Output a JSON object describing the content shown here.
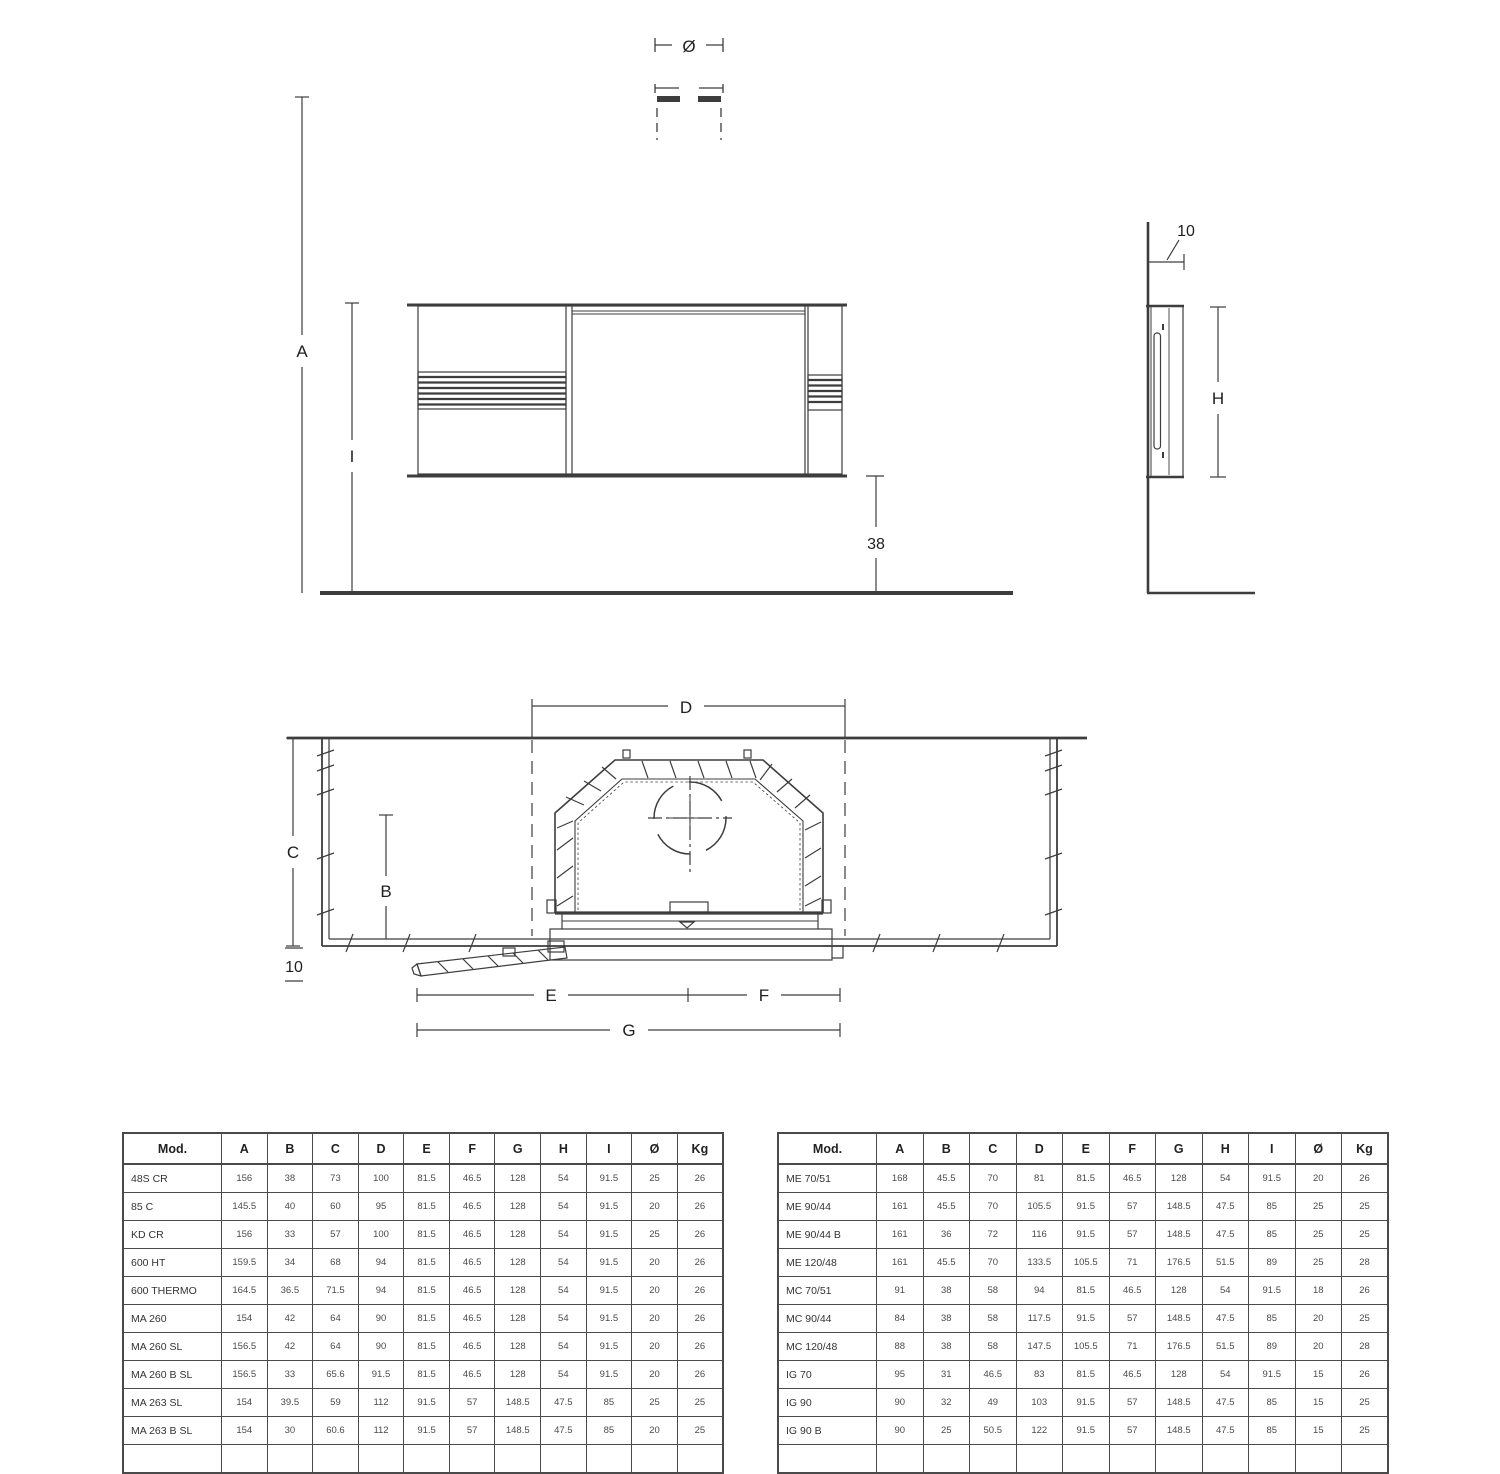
{
  "drawing": {
    "front_view": {
      "labels": {
        "height_total": "A",
        "height_body_top": "I",
        "bottom_offset": "38",
        "flue_diameter": "Ø"
      }
    },
    "side_view": {
      "labels": {
        "wall_offset": "10",
        "body_height": "H"
      }
    },
    "plan_view": {
      "labels": {
        "top_width": "D",
        "depth_total": "C",
        "depth_inner": "B",
        "front_thickness": "10",
        "left_span": "E",
        "right_span": "F",
        "full_span": "G"
      }
    }
  },
  "tables": {
    "left": {
      "columns": [
        "Mod.",
        "A",
        "B",
        "C",
        "D",
        "E",
        "F",
        "G",
        "H",
        "I",
        "Ø",
        "Kg"
      ],
      "rows": [
        [
          "48S CR",
          "156",
          "38",
          "73",
          "100",
          "81.5",
          "46.5",
          "128",
          "54",
          "91.5",
          "25",
          "26"
        ],
        [
          "85 C",
          "145.5",
          "40",
          "60",
          "95",
          "81.5",
          "46.5",
          "128",
          "54",
          "91.5",
          "20",
          "26"
        ],
        [
          "KD CR",
          "156",
          "33",
          "57",
          "100",
          "81.5",
          "46.5",
          "128",
          "54",
          "91.5",
          "25",
          "26"
        ],
        [
          "600 HT",
          "159.5",
          "34",
          "68",
          "94",
          "81.5",
          "46.5",
          "128",
          "54",
          "91.5",
          "20",
          "26"
        ],
        [
          "600 THERMO",
          "164.5",
          "36.5",
          "71.5",
          "94",
          "81.5",
          "46.5",
          "128",
          "54",
          "91.5",
          "20",
          "26"
        ],
        [
          "MA 260",
          "154",
          "42",
          "64",
          "90",
          "81.5",
          "46.5",
          "128",
          "54",
          "91.5",
          "20",
          "26"
        ],
        [
          "MA 260 SL",
          "156.5",
          "42",
          "64",
          "90",
          "81.5",
          "46.5",
          "128",
          "54",
          "91.5",
          "20",
          "26"
        ],
        [
          "MA 260 B SL",
          "156.5",
          "33",
          "65.6",
          "91.5",
          "81.5",
          "46.5",
          "128",
          "54",
          "91.5",
          "20",
          "26"
        ],
        [
          "MA 263 SL",
          "154",
          "39.5",
          "59",
          "112",
          "91.5",
          "57",
          "148.5",
          "47.5",
          "85",
          "25",
          "25"
        ],
        [
          "MA 263 B SL",
          "154",
          "30",
          "60.6",
          "112",
          "91.5",
          "57",
          "148.5",
          "47.5",
          "85",
          "20",
          "25"
        ]
      ],
      "has_partial_next_row": true
    },
    "right": {
      "columns": [
        "Mod.",
        "A",
        "B",
        "C",
        "D",
        "E",
        "F",
        "G",
        "H",
        "I",
        "Ø",
        "Kg"
      ],
      "rows": [
        [
          "ME 70/51",
          "168",
          "45.5",
          "70",
          "81",
          "81.5",
          "46.5",
          "128",
          "54",
          "91.5",
          "20",
          "26"
        ],
        [
          "ME 90/44",
          "161",
          "45.5",
          "70",
          "105.5",
          "91.5",
          "57",
          "148.5",
          "47.5",
          "85",
          "25",
          "25"
        ],
        [
          "ME 90/44 B",
          "161",
          "36",
          "72",
          "116",
          "91.5",
          "57",
          "148.5",
          "47.5",
          "85",
          "25",
          "25"
        ],
        [
          "ME 120/48",
          "161",
          "45.5",
          "70",
          "133.5",
          "105.5",
          "71",
          "176.5",
          "51.5",
          "89",
          "25",
          "28"
        ],
        [
          "MC 70/51",
          "91",
          "38",
          "58",
          "94",
          "81.5",
          "46.5",
          "128",
          "54",
          "91.5",
          "18",
          "26"
        ],
        [
          "MC 90/44",
          "84",
          "38",
          "58",
          "117.5",
          "91.5",
          "57",
          "148.5",
          "47.5",
          "85",
          "20",
          "25"
        ],
        [
          "MC 120/48",
          "88",
          "38",
          "58",
          "147.5",
          "105.5",
          "71",
          "176.5",
          "51.5",
          "89",
          "20",
          "28"
        ],
        [
          "IG 70",
          "95",
          "31",
          "46.5",
          "83",
          "81.5",
          "46.5",
          "128",
          "54",
          "91.5",
          "15",
          "26"
        ],
        [
          "IG 90",
          "90",
          "32",
          "49",
          "103",
          "91.5",
          "57",
          "148.5",
          "47.5",
          "85",
          "15",
          "25"
        ],
        [
          "IG 90 B",
          "90",
          "25",
          "50.5",
          "122",
          "91.5",
          "57",
          "148.5",
          "47.5",
          "85",
          "15",
          "25"
        ]
      ],
      "has_partial_next_row": true
    }
  }
}
